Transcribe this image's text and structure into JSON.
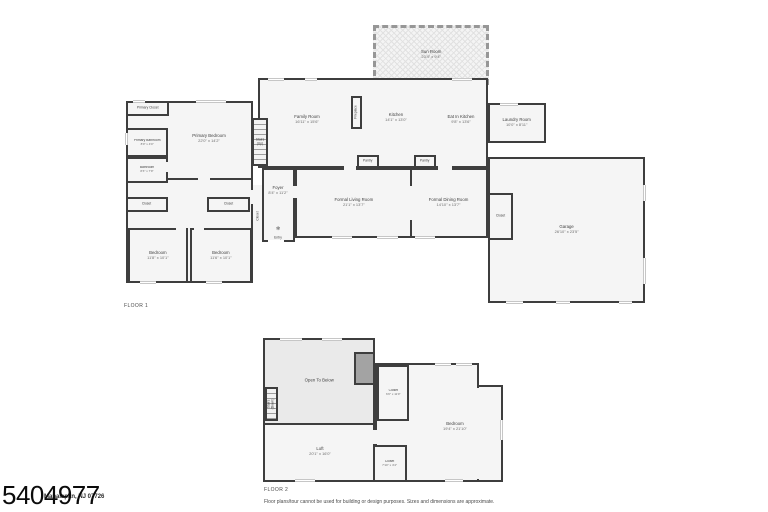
{
  "colors": {
    "wall": "#3e3e3e",
    "room_fill": "#f5f5f5",
    "open_below_fill": "#eaeaea",
    "sun_room_wall": "#979797",
    "window_trim": "#c6c6c6"
  },
  "floor1": {
    "label": "FLOOR 1",
    "rooms": {
      "sun_room": {
        "name": "Sun Room",
        "dims": "23'4\" x 9'4\""
      },
      "family_room": {
        "name": "Family Room",
        "dims": "16'11\" x 15'6\""
      },
      "fireplace": {
        "name": "Fireplace"
      },
      "kitchen": {
        "name": "Kitchen",
        "dims": "14'1\" x 13'0\""
      },
      "eat_in_kitchen": {
        "name": "Eat In Kitchen",
        "dims": "9'8\" x 13'6\""
      },
      "laundry_room": {
        "name": "Laundry Room",
        "dims": "10'0\" x 8'11\""
      },
      "pantry_a": {
        "name": "Pantry"
      },
      "pantry_b": {
        "name": "Pantry"
      },
      "primary_closet": {
        "name": "Primary Closet"
      },
      "primary_bedroom": {
        "name": "Primary Bedroom",
        "dims": "22'0\" x 14'2\""
      },
      "primary_bathroom": {
        "name": "Primary Bathroom",
        "dims": "8'0\" x 4'0\""
      },
      "bathroom": {
        "name": "Bathroom",
        "dims": "8'3\" x 7'9\""
      },
      "closet_hall": {
        "name": "Closet"
      },
      "closet_mid": {
        "name": "Closet"
      },
      "closet_small": {
        "name": "Closet"
      },
      "stairs_up": {
        "name": "Stairs",
        "dims": "(Up)"
      },
      "bedroom_left": {
        "name": "Bedroom",
        "dims": "11'8\" x 10'1\""
      },
      "bedroom_right": {
        "name": "Bedroom",
        "dims": "11'6\" x 10'1\""
      },
      "foyer": {
        "name": "Foyer",
        "dims": "8'4\" x 11'2\""
      },
      "entry": {
        "name": "Entry"
      },
      "formal_living_room": {
        "name": "Formal Living Room",
        "dims": "21'1\" x 13'7\""
      },
      "formal_dining_room": {
        "name": "Formal Dining Room",
        "dims": "14'10\" x 13'7\""
      },
      "garage_closet": {
        "name": "Closet"
      },
      "garage": {
        "name": "Garage",
        "dims": "26'10\" x 23'5\""
      }
    }
  },
  "floor2": {
    "label": "FLOOR 2",
    "rooms": {
      "open_to_below": {
        "name": "Open To Below"
      },
      "stairs_down": {
        "name": "Stairs",
        "dims": "(Down)"
      },
      "closet_upper": {
        "name": "Closet",
        "dims": "6'0\" x 11'0\""
      },
      "bedroom": {
        "name": "Bedroom",
        "dims": "19'4\" x 21'10\""
      },
      "loft": {
        "name": "Loft",
        "dims": "20'1\" x 16'0\""
      },
      "closet_lower": {
        "name": "Closet",
        "dims": "7'10\" x 4'4\""
      }
    }
  },
  "footer": {
    "watermark": "5404977",
    "address": "Manalapan, NJ 07726",
    "disclaimer": "Floor plans/tour cannot be used for building or design purposes. Sizes and dimensions are approximate."
  }
}
